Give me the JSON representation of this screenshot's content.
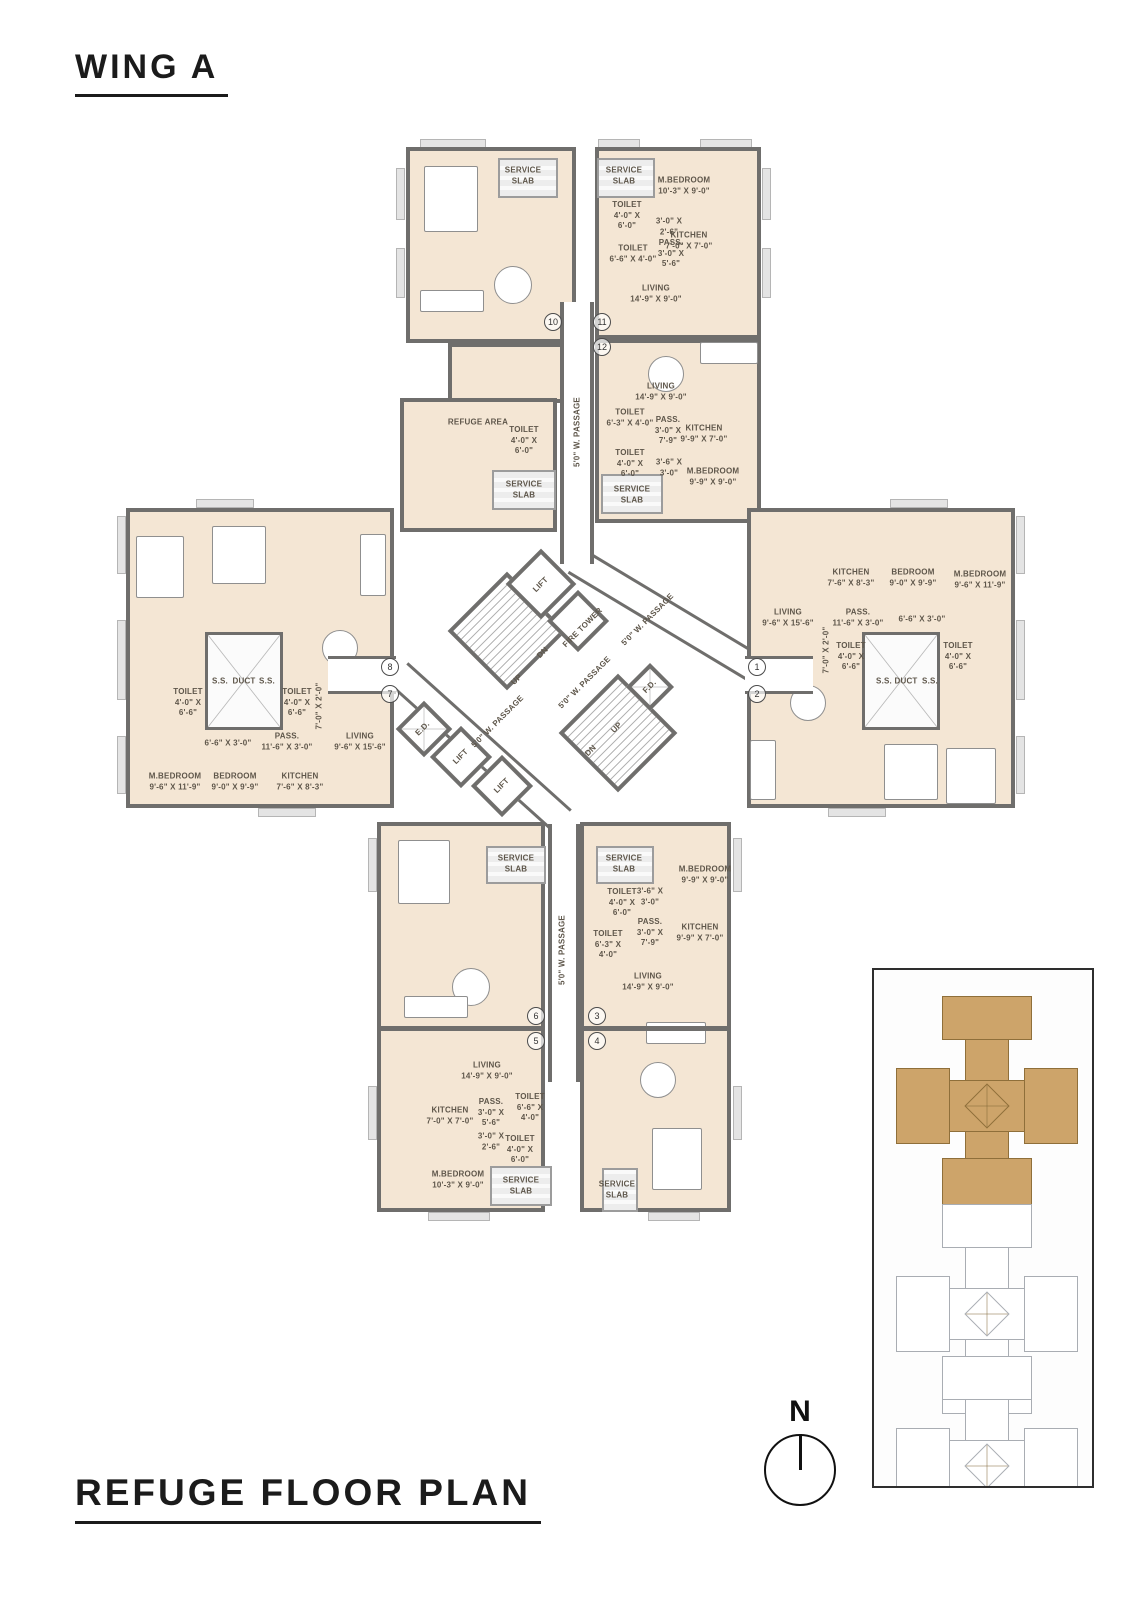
{
  "page": {
    "wing_title": "WING A",
    "plan_title": "REFUGE FLOOR PLAN",
    "north_label": "N"
  },
  "colors": {
    "room_fill": "#f4e6d4",
    "wall": "#6f6e6c",
    "service_fill": "#ededed",
    "keyplan_highlight": "#cda46a",
    "keyplan_outline": "#a9adb3"
  },
  "plan": {
    "blocks": [
      {
        "cls": "unit",
        "x": 406,
        "y": 147,
        "w": 170,
        "h": 196
      },
      {
        "cls": "unit",
        "x": 448,
        "y": 343,
        "w": 128,
        "h": 60
      },
      {
        "cls": "unit",
        "x": 400,
        "y": 398,
        "w": 157,
        "h": 134
      },
      {
        "cls": "unit",
        "x": 595,
        "y": 147,
        "w": 166,
        "h": 192
      },
      {
        "cls": "unit",
        "x": 595,
        "y": 339,
        "w": 166,
        "h": 184
      },
      {
        "cls": "unit",
        "x": 126,
        "y": 508,
        "w": 268,
        "h": 300
      },
      {
        "cls": "unit",
        "x": 747,
        "y": 508,
        "w": 268,
        "h": 300
      },
      {
        "cls": "unit",
        "x": 377,
        "y": 822,
        "w": 168,
        "h": 390
      },
      {
        "cls": "unit",
        "x": 580,
        "y": 822,
        "w": 151,
        "h": 390
      },
      {
        "cls": "pass",
        "x": 560,
        "y": 302,
        "w": 34,
        "h": 262
      },
      {
        "cls": "pass",
        "x": 548,
        "y": 824,
        "w": 32,
        "h": 258
      },
      {
        "cls": "corr",
        "x": 328,
        "y": 656,
        "w": 68,
        "h": 38
      },
      {
        "cls": "corr",
        "x": 745,
        "y": 656,
        "w": 68,
        "h": 38
      },
      {
        "cls": "wall",
        "x": 379,
        "y": 1026,
        "w": 164,
        "h": 5
      },
      {
        "cls": "wall",
        "x": 582,
        "y": 1026,
        "w": 147,
        "h": 5
      },
      {
        "cls": "duct",
        "x": 205,
        "y": 632,
        "w": 78,
        "h": 98
      },
      {
        "cls": "duct",
        "x": 862,
        "y": 632,
        "w": 78,
        "h": 98
      },
      {
        "cls": "slab",
        "x": 498,
        "y": 158,
        "w": 60,
        "h": 40
      },
      {
        "cls": "slab",
        "x": 597,
        "y": 158,
        "w": 58,
        "h": 40
      },
      {
        "cls": "slab",
        "x": 492,
        "y": 470,
        "w": 64,
        "h": 40
      },
      {
        "cls": "slab",
        "x": 601,
        "y": 474,
        "w": 62,
        "h": 40
      },
      {
        "cls": "slab",
        "x": 486,
        "y": 846,
        "w": 60,
        "h": 38
      },
      {
        "cls": "slab",
        "x": 596,
        "y": 846,
        "w": 58,
        "h": 38
      },
      {
        "cls": "slab",
        "x": 490,
        "y": 1166,
        "w": 62,
        "h": 40
      },
      {
        "cls": "slab",
        "x": 602,
        "y": 1168,
        "w": 36,
        "h": 44
      },
      {
        "cls": "ledge",
        "x": 420,
        "y": 139,
        "w": 66,
        "h": 9
      },
      {
        "cls": "ledge",
        "x": 598,
        "y": 139,
        "w": 42,
        "h": 9
      },
      {
        "cls": "ledge",
        "x": 700,
        "y": 139,
        "w": 52,
        "h": 9
      },
      {
        "cls": "ledge",
        "x": 396,
        "y": 168,
        "w": 9,
        "h": 52
      },
      {
        "cls": "ledge",
        "x": 396,
        "y": 248,
        "w": 9,
        "h": 50
      },
      {
        "cls": "ledge",
        "x": 762,
        "y": 168,
        "w": 9,
        "h": 52
      },
      {
        "cls": "ledge",
        "x": 762,
        "y": 248,
        "w": 9,
        "h": 50
      },
      {
        "cls": "ledge",
        "x": 117,
        "y": 516,
        "w": 9,
        "h": 58
      },
      {
        "cls": "ledge",
        "x": 117,
        "y": 620,
        "w": 9,
        "h": 80
      },
      {
        "cls": "ledge",
        "x": 117,
        "y": 736,
        "w": 9,
        "h": 58
      },
      {
        "cls": "ledge",
        "x": 1016,
        "y": 516,
        "w": 9,
        "h": 58
      },
      {
        "cls": "ledge",
        "x": 1016,
        "y": 620,
        "w": 9,
        "h": 80
      },
      {
        "cls": "ledge",
        "x": 1016,
        "y": 736,
        "w": 9,
        "h": 58
      },
      {
        "cls": "ledge",
        "x": 368,
        "y": 838,
        "w": 9,
        "h": 54
      },
      {
        "cls": "ledge",
        "x": 368,
        "y": 1086,
        "w": 9,
        "h": 54
      },
      {
        "cls": "ledge",
        "x": 733,
        "y": 838,
        "w": 9,
        "h": 54
      },
      {
        "cls": "ledge",
        "x": 733,
        "y": 1086,
        "w": 9,
        "h": 54
      },
      {
        "cls": "ledge",
        "x": 428,
        "y": 1212,
        "w": 62,
        "h": 9
      },
      {
        "cls": "ledge",
        "x": 648,
        "y": 1212,
        "w": 52,
        "h": 9
      },
      {
        "cls": "ledge",
        "x": 196,
        "y": 499,
        "w": 58,
        "h": 9
      },
      {
        "cls": "ledge",
        "x": 258,
        "y": 808,
        "w": 58,
        "h": 9
      },
      {
        "cls": "ledge",
        "x": 890,
        "y": 499,
        "w": 58,
        "h": 9
      },
      {
        "cls": "ledge",
        "x": 828,
        "y": 808,
        "w": 58,
        "h": 9
      }
    ],
    "strips": [
      {
        "cx": 667,
        "cy": 616,
        "len": 215,
        "th": 30,
        "rot": 31
      },
      {
        "cx": 480,
        "cy": 747,
        "len": 220,
        "th": 30,
        "rot": 42
      }
    ],
    "diamonds": [
      {
        "cls": "dia stair",
        "cx": 507,
        "cy": 631,
        "s": 84
      },
      {
        "cls": "dia",
        "cx": 541,
        "cy": 584,
        "s": 50
      },
      {
        "cls": "dia",
        "cx": 578,
        "cy": 621,
        "s": 44
      },
      {
        "cls": "dia stair",
        "cx": 618,
        "cy": 733,
        "s": 84
      },
      {
        "cls": "dia x",
        "cx": 650,
        "cy": 687,
        "s": 34
      },
      {
        "cls": "dia x",
        "cx": 424,
        "cy": 729,
        "s": 40
      },
      {
        "cls": "dia",
        "cx": 461,
        "cy": 757,
        "s": 44
      },
      {
        "cls": "dia",
        "cx": 502,
        "cy": 786,
        "s": 44
      }
    ],
    "furniture": [
      {
        "cls": "furn",
        "x": 424,
        "y": 166,
        "w": 54,
        "h": 66
      },
      {
        "cls": "furn round",
        "x": 494,
        "y": 266,
        "w": 38,
        "h": 38
      },
      {
        "cls": "furn",
        "x": 420,
        "y": 290,
        "w": 64,
        "h": 22
      },
      {
        "cls": "furn",
        "x": 700,
        "y": 342,
        "w": 58,
        "h": 22
      },
      {
        "cls": "furn round",
        "x": 648,
        "y": 356,
        "w": 36,
        "h": 36
      },
      {
        "cls": "furn",
        "x": 136,
        "y": 536,
        "w": 48,
        "h": 62
      },
      {
        "cls": "furn",
        "x": 212,
        "y": 526,
        "w": 54,
        "h": 58
      },
      {
        "cls": "furn",
        "x": 360,
        "y": 534,
        "w": 26,
        "h": 62
      },
      {
        "cls": "furn round",
        "x": 322,
        "y": 630,
        "w": 36,
        "h": 36
      },
      {
        "cls": "furn round",
        "x": 790,
        "y": 685,
        "w": 36,
        "h": 36
      },
      {
        "cls": "furn",
        "x": 750,
        "y": 740,
        "w": 26,
        "h": 60
      },
      {
        "cls": "furn",
        "x": 884,
        "y": 744,
        "w": 54,
        "h": 56
      },
      {
        "cls": "furn",
        "x": 946,
        "y": 748,
        "w": 50,
        "h": 56
      },
      {
        "cls": "furn",
        "x": 398,
        "y": 840,
        "w": 52,
        "h": 64
      },
      {
        "cls": "furn round",
        "x": 452,
        "y": 968,
        "w": 38,
        "h": 38
      },
      {
        "cls": "furn",
        "x": 404,
        "y": 996,
        "w": 64,
        "h": 22
      },
      {
        "cls": "furn",
        "x": 646,
        "y": 1022,
        "w": 60,
        "h": 22
      },
      {
        "cls": "furn round",
        "x": 640,
        "y": 1062,
        "w": 36,
        "h": 36
      },
      {
        "cls": "furn",
        "x": 652,
        "y": 1128,
        "w": 50,
        "h": 62
      }
    ],
    "labels": [
      {
        "t": "SERVICE\nSLAB",
        "x": 523,
        "y": 176
      },
      {
        "t": "SERVICE\nSLAB",
        "x": 624,
        "y": 176
      },
      {
        "t": "M.BEDROOM\n10'-3\" X 9'-0\"",
        "x": 684,
        "y": 186
      },
      {
        "t": "TOILET\n4'-0\" X\n6'-0\"",
        "x": 627,
        "y": 216
      },
      {
        "t": "3'-0\" X\n2'-6\"",
        "x": 669,
        "y": 227
      },
      {
        "t": "KITCHEN\n7'-0\" X 7'-0\"",
        "x": 689,
        "y": 241
      },
      {
        "t": "TOILET\n6'-6\" X 4'-0\"",
        "x": 633,
        "y": 254
      },
      {
        "t": "PASS.\n3'-0\" X\n5'-6\"",
        "x": 671,
        "y": 254
      },
      {
        "t": "LIVING\n14'-9\" X 9'-0\"",
        "x": 656,
        "y": 294
      },
      {
        "t": "LIVING\n14'-9\" X 9'-0\"",
        "x": 661,
        "y": 392
      },
      {
        "t": "TOILET\n6'-3\" X 4'-0\"",
        "x": 630,
        "y": 418
      },
      {
        "t": "PASS.\n3'-0\" X\n7'-9\"",
        "x": 668,
        "y": 431
      },
      {
        "t": "KITCHEN\n9'-9\" X 7'-0\"",
        "x": 704,
        "y": 434
      },
      {
        "t": "TOILET\n4'-0\" X\n6'-0\"",
        "x": 630,
        "y": 464
      },
      {
        "t": "3'-6\" X\n3'-0\"",
        "x": 669,
        "y": 468
      },
      {
        "t": "M.BEDROOM\n9'-9\" X 9'-0\"",
        "x": 713,
        "y": 477
      },
      {
        "t": "SERVICE\nSLAB",
        "x": 632,
        "y": 495
      },
      {
        "t": "REFUGE AREA",
        "x": 478,
        "y": 423
      },
      {
        "t": "TOILET\n4'-0\" X\n6'-0\"",
        "x": 524,
        "y": 441
      },
      {
        "t": "SERVICE\nSLAB",
        "x": 524,
        "y": 490
      },
      {
        "t": "5'0\" W. PASSAGE",
        "x": 578,
        "y": 432,
        "r": -90
      },
      {
        "t": "S.S.",
        "x": 220,
        "y": 682
      },
      {
        "t": "DUCT",
        "x": 244,
        "y": 682
      },
      {
        "t": "S.S.",
        "x": 267,
        "y": 682
      },
      {
        "t": "TOILET\n4'-0\" X\n6'-6\"",
        "x": 188,
        "y": 703
      },
      {
        "t": "TOILET\n4'-0\" X\n6'-6\"",
        "x": 297,
        "y": 703
      },
      {
        "t": "7'-0\" X 2'-0\"",
        "x": 320,
        "y": 706,
        "r": -90
      },
      {
        "t": "6'-6\" X 3'-0\"",
        "x": 228,
        "y": 744
      },
      {
        "t": "PASS.\n11'-6\" X 3'-0\"",
        "x": 287,
        "y": 742
      },
      {
        "t": "LIVING\n9'-6\" X 15'-6\"",
        "x": 360,
        "y": 742
      },
      {
        "t": "M.BEDROOM\n9'-6\" X 11'-9\"",
        "x": 175,
        "y": 782
      },
      {
        "t": "BEDROOM\n9'-0\" X 9'-9\"",
        "x": 235,
        "y": 782
      },
      {
        "t": "KITCHEN\n7'-6\" X 8'-3\"",
        "x": 300,
        "y": 782
      },
      {
        "t": "KITCHEN\n7'-6\" X 8'-3\"",
        "x": 851,
        "y": 578
      },
      {
        "t": "BEDROOM\n9'-0\" X 9'-9\"",
        "x": 913,
        "y": 578
      },
      {
        "t": "M.BEDROOM\n9'-6\" X 11'-9\"",
        "x": 980,
        "y": 580
      },
      {
        "t": "LIVING\n9'-6\" X 15'-6\"",
        "x": 788,
        "y": 618
      },
      {
        "t": "PASS.\n11'-6\" X 3'-0\"",
        "x": 858,
        "y": 618
      },
      {
        "t": "6'-6\" X 3'-0\"",
        "x": 922,
        "y": 620
      },
      {
        "t": "7'-0\" X 2'-0\"",
        "x": 827,
        "y": 650,
        "r": -90
      },
      {
        "t": "TOILET\n4'-0\" X\n6'-6\"",
        "x": 851,
        "y": 657
      },
      {
        "t": "TOILET\n4'-0\" X\n6'-6\"",
        "x": 958,
        "y": 657
      },
      {
        "t": "S.S.",
        "x": 884,
        "y": 682
      },
      {
        "t": "DUCT",
        "x": 906,
        "y": 682
      },
      {
        "t": "S.S.",
        "x": 930,
        "y": 682
      },
      {
        "t": "LIFT",
        "x": 541,
        "y": 585,
        "r": -45
      },
      {
        "t": "FIRE TOWER",
        "x": 583,
        "y": 628,
        "r": -45
      },
      {
        "t": "DN",
        "x": 543,
        "y": 653,
        "r": -45
      },
      {
        "t": "UP",
        "x": 517,
        "y": 680,
        "r": -45
      },
      {
        "t": "5'0\" W. PASSAGE",
        "x": 648,
        "y": 620,
        "r": -45
      },
      {
        "t": "5'0\" W. PASSAGE",
        "x": 585,
        "y": 683,
        "r": -45
      },
      {
        "t": "5'0\" W. PASSAGE",
        "x": 498,
        "y": 722,
        "r": -45
      },
      {
        "t": "F.D.",
        "x": 650,
        "y": 687,
        "r": -45
      },
      {
        "t": "E.D.",
        "x": 423,
        "y": 729,
        "r": -45
      },
      {
        "t": "UP",
        "x": 617,
        "y": 728,
        "r": -45
      },
      {
        "t": "DN",
        "x": 591,
        "y": 751,
        "r": -45
      },
      {
        "t": "LIFT",
        "x": 461,
        "y": 757,
        "r": -45
      },
      {
        "t": "LIFT",
        "x": 502,
        "y": 786,
        "r": -45
      },
      {
        "t": "SERVICE\nSLAB",
        "x": 516,
        "y": 864
      },
      {
        "t": "SERVICE\nSLAB",
        "x": 624,
        "y": 864
      },
      {
        "t": "M.BEDROOM\n9'-9\" X 9'-0\"",
        "x": 705,
        "y": 875
      },
      {
        "t": "TOILET\n4'-0\" X\n6'-0\"",
        "x": 622,
        "y": 903
      },
      {
        "t": "3'-6\" X\n3'-0\"",
        "x": 650,
        "y": 897
      },
      {
        "t": "PASS.\n3'-0\" X\n7'-9\"",
        "x": 650,
        "y": 933
      },
      {
        "t": "KITCHEN\n9'-9\" X 7'-0\"",
        "x": 700,
        "y": 933
      },
      {
        "t": "TOILET\n6'-3\" X\n4'-0\"",
        "x": 608,
        "y": 945
      },
      {
        "t": "LIVING\n14'-9\" X 9'-0\"",
        "x": 648,
        "y": 982
      },
      {
        "t": "5'0\" W. PASSAGE",
        "x": 563,
        "y": 950,
        "r": -90
      },
      {
        "t": "LIVING\n14'-9\" X 9'-0\"",
        "x": 487,
        "y": 1071
      },
      {
        "t": "KITCHEN\n7'-0\" X 7'-0\"",
        "x": 450,
        "y": 1116
      },
      {
        "t": "PASS.\n3'-0\" X\n5'-6\"",
        "x": 491,
        "y": 1113
      },
      {
        "t": "TOILET\n6'-6\" X\n4'-0\"",
        "x": 530,
        "y": 1108
      },
      {
        "t": "3'-0\" X\n2'-6\"",
        "x": 491,
        "y": 1142
      },
      {
        "t": "TOILET\n4'-0\" X\n6'-0\"",
        "x": 520,
        "y": 1150
      },
      {
        "t": "M.BEDROOM\n10'-3\" X 9'-0\"",
        "x": 458,
        "y": 1180
      },
      {
        "t": "SERVICE\nSLAB",
        "x": 521,
        "y": 1186
      },
      {
        "t": "SERVICE\nSLAB",
        "x": 617,
        "y": 1190
      }
    ],
    "unit_markers": [
      {
        "n": "10",
        "x": 553,
        "y": 322
      },
      {
        "n": "11",
        "x": 602,
        "y": 322
      },
      {
        "n": "12",
        "x": 602,
        "y": 347
      },
      {
        "n": "8",
        "x": 390,
        "y": 667
      },
      {
        "n": "7",
        "x": 390,
        "y": 694
      },
      {
        "n": "1",
        "x": 757,
        "y": 667
      },
      {
        "n": "2",
        "x": 757,
        "y": 694
      },
      {
        "n": "6",
        "x": 536,
        "y": 1016
      },
      {
        "n": "3",
        "x": 597,
        "y": 1016
      },
      {
        "n": "5",
        "x": 536,
        "y": 1041
      },
      {
        "n": "4",
        "x": 597,
        "y": 1041
      }
    ]
  },
  "keyplan": {
    "box": {
      "x": 872,
      "y": 968,
      "w": 222,
      "h": 520
    },
    "parts": [
      {
        "x": 91,
        "y": 36,
        "w": 44,
        "h": 200
      },
      {
        "x": 33,
        "y": 110,
        "w": 160,
        "h": 52
      },
      {
        "x": 68,
        "y": 26,
        "w": 90,
        "h": 44
      },
      {
        "x": 68,
        "y": 188,
        "w": 90,
        "h": 48
      },
      {
        "x": 22,
        "y": 98,
        "w": 54,
        "h": 76
      },
      {
        "x": 150,
        "y": 98,
        "w": 54,
        "h": 76
      },
      {
        "x": 97,
        "y": 120,
        "w": 32,
        "h": 32,
        "rot": 45,
        "core": true
      }
    ],
    "crosses": [
      {
        "dy": 0,
        "cls": "kp-hi"
      },
      {
        "dy": 208,
        "cls": "kp-ol"
      },
      {
        "dy": 360,
        "cls": "kp-ol"
      }
    ]
  },
  "north": {
    "cx": 800,
    "cy": 1470,
    "r": 36,
    "label_y": 1412
  }
}
